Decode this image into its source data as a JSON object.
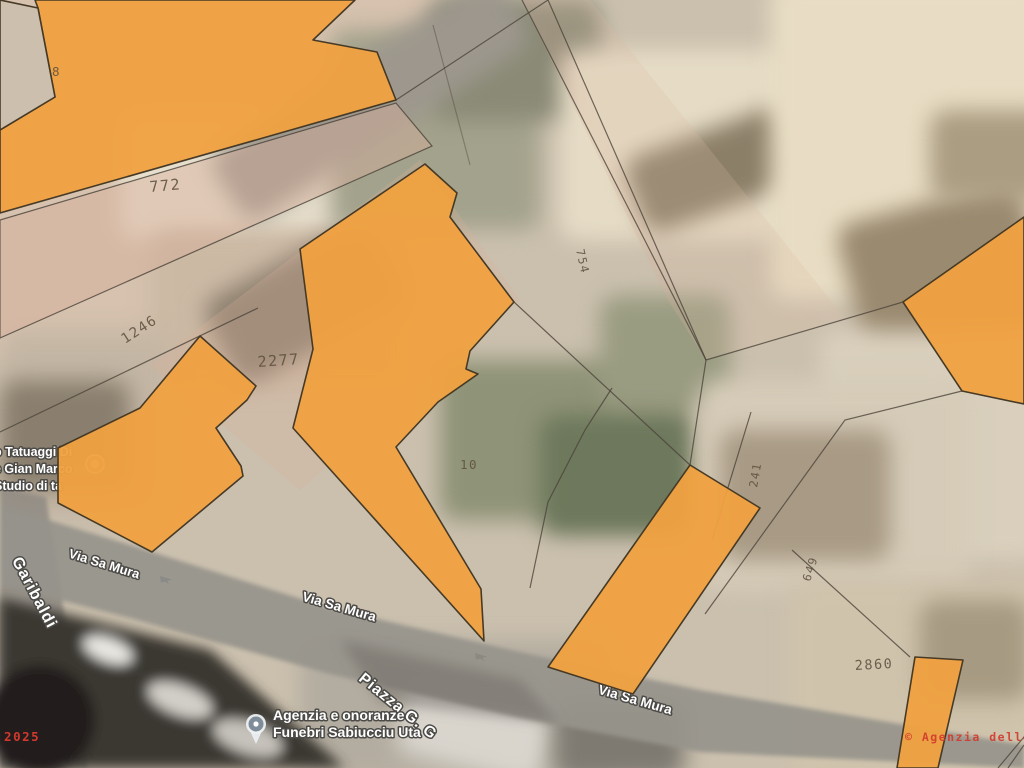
{
  "map": {
    "parcels": [
      {
        "label": "8"
      },
      {
        "label": "772"
      },
      {
        "label": "1246"
      },
      {
        "label": "2277"
      },
      {
        "label": "754"
      },
      {
        "label": "10"
      },
      {
        "label": "241"
      },
      {
        "label": "649"
      },
      {
        "label": "2860"
      }
    ],
    "streets": {
      "via_sa_mura": "Via Sa Mura",
      "garibaldi": "Garibaldi",
      "piazza": "Piazza G. G"
    },
    "pois": {
      "tattoo_studio": {
        "line1": "o Tatuaggi Di",
        "line2": "e Gian Marco",
        "line3": "Studio di ta"
      },
      "funeral_agency": {
        "line1": "Agenzia e onoranze",
        "line2": "Funebri Sabiucciu Uta"
      }
    },
    "watermarks": {
      "year": "© 2025",
      "agency": "© Agenzia delle E"
    },
    "colors": {
      "parcel_fill": "#F0A140",
      "parcel_outline": "#463A26",
      "cadastral_line": "#4A4238",
      "parcel_label": "#5E5040",
      "watermark_red": "#D2392C",
      "road_grey": "#97938C"
    }
  }
}
